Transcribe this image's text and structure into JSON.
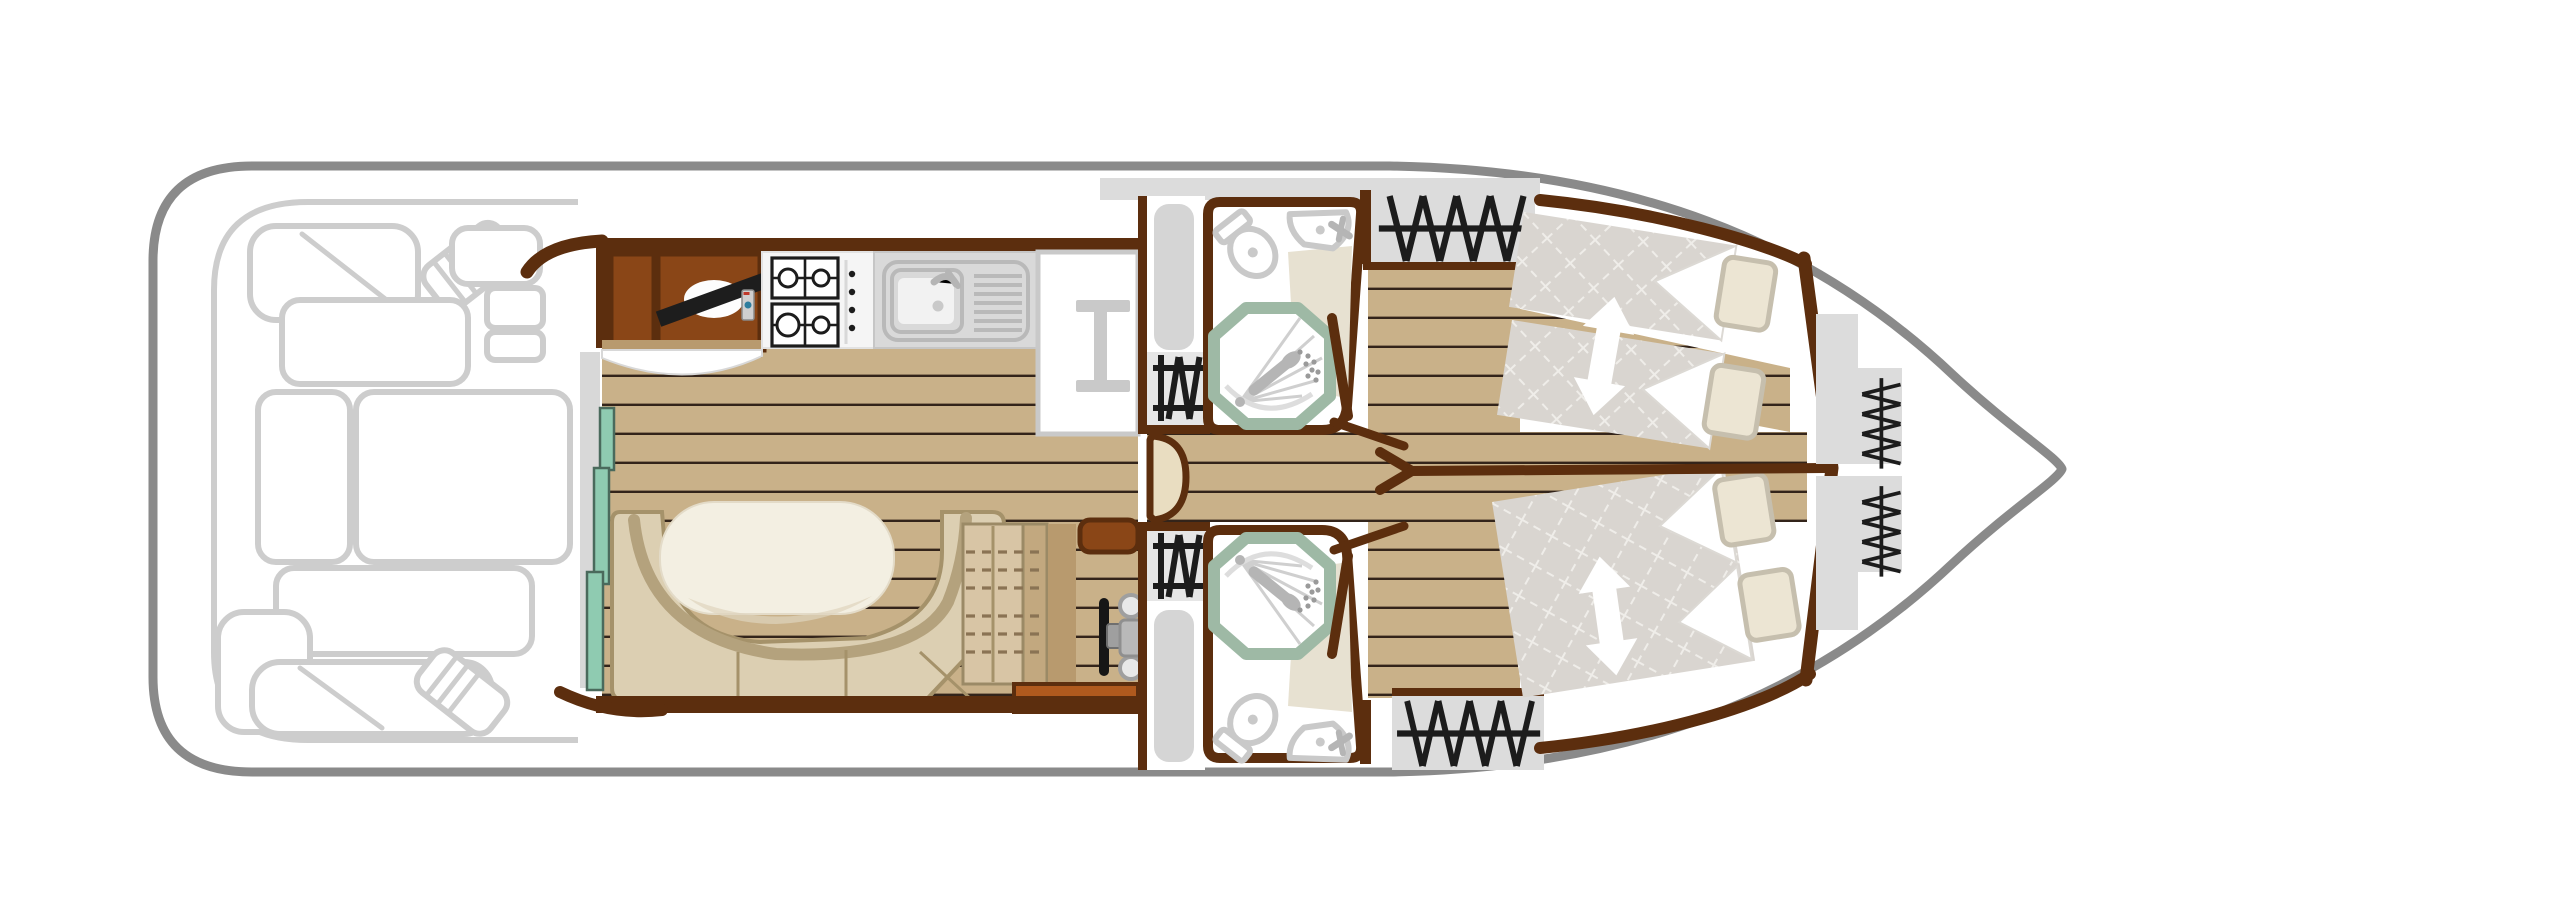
{
  "diagram": {
    "type": "boat-floor-plan",
    "description": "Top-view deck plan of a canal cruiser, bow pointing right, no visible text labels",
    "orientation": "bow-right"
  },
  "colors": {
    "hullOutline": "#8a8a8a",
    "deckFurniture": "#cdcdcd",
    "wallBrown": "#5c2e0e",
    "cabinetBrown": "#8a4617",
    "woodFloor": "#c9b189",
    "woodDark": "#b89a6e",
    "plankLine": "#33241a",
    "mintDoor": "#8fcbb1",
    "mintBorder": "#4a6a5c",
    "trackGray": "#d8d8d8",
    "benchBeige": "#dccfb2",
    "benchOutline": "#a5926a",
    "benchBack": "#b4a27d",
    "tableCream": "#f3efe2",
    "mattressGray": "#d9d5d0",
    "mattressGrid": "#efede9",
    "pillowFill": "#ece5d3",
    "pillowBorder": "#c6bfae",
    "fixtureGray": "#c9c9c9",
    "showerRing": "#9eb9a5",
    "bathMat": "#e7e1d1",
    "iconBlack": "#1c1c1c",
    "sideDeckGray": "#dcdcdc",
    "alcoveGray": "#e6e6e6",
    "doorTan": "#e9ddc1",
    "stepSienna": "#b05a1e",
    "counterWhite": "#f5f5f5",
    "sinkGray": "#d9d9d9",
    "arrowWhite": "#ffffff",
    "tvBlack": "#1d1d1d"
  },
  "rooms": [
    {
      "name": "aft-deck",
      "features": [
        "corner bench seating",
        "sun pads",
        "outside helm seat",
        "steering console"
      ]
    },
    {
      "name": "saloon",
      "features": [
        "TV cabinet",
        "television",
        "remote control",
        "sliding patio door",
        "wood plank floor"
      ]
    },
    {
      "name": "galley",
      "features": [
        "4-burner gas hob",
        "sink with drainer",
        "fridge storage unit"
      ]
    },
    {
      "name": "dinette",
      "features": [
        "U-shaped bench",
        "oval table",
        "storage chest"
      ]
    },
    {
      "name": "inner-helm",
      "features": [
        "steering wheel",
        "helm seat",
        "console",
        "step platform"
      ]
    },
    {
      "name": "port-side-entry",
      "features": [
        "side door",
        "companionway steps"
      ]
    },
    {
      "name": "starboard-side-entry",
      "features": [
        "side door",
        "companionway steps"
      ]
    },
    {
      "name": "bathroom-port",
      "features": [
        "shower",
        "toilet",
        "washbasin",
        "bath mat"
      ]
    },
    {
      "name": "bathroom-starboard",
      "features": [
        "shower",
        "toilet",
        "washbasin",
        "bath mat"
      ]
    },
    {
      "name": "cabin-port",
      "features": [
        "two sliding single beds",
        "pillows",
        "slide arrow",
        "wardrobe with hangers"
      ]
    },
    {
      "name": "cabin-starboard",
      "features": [
        "sliding double bed",
        "pillows",
        "slide arrow",
        "wardrobe with hangers"
      ]
    },
    {
      "name": "bow-storage",
      "features": [
        "hanging wardrobe",
        "hanging wardrobe"
      ]
    }
  ],
  "icons": [
    "tv-icon",
    "remote-icon",
    "gas-hob-icon",
    "sink-icon",
    "fridge-icon",
    "companionway-steps-icon",
    "shower-icon",
    "toilet-icon",
    "washbasin-icon",
    "helm-wheel-icon",
    "hangers-icon",
    "slide-arrow-icon",
    "door-swing-icon"
  ]
}
